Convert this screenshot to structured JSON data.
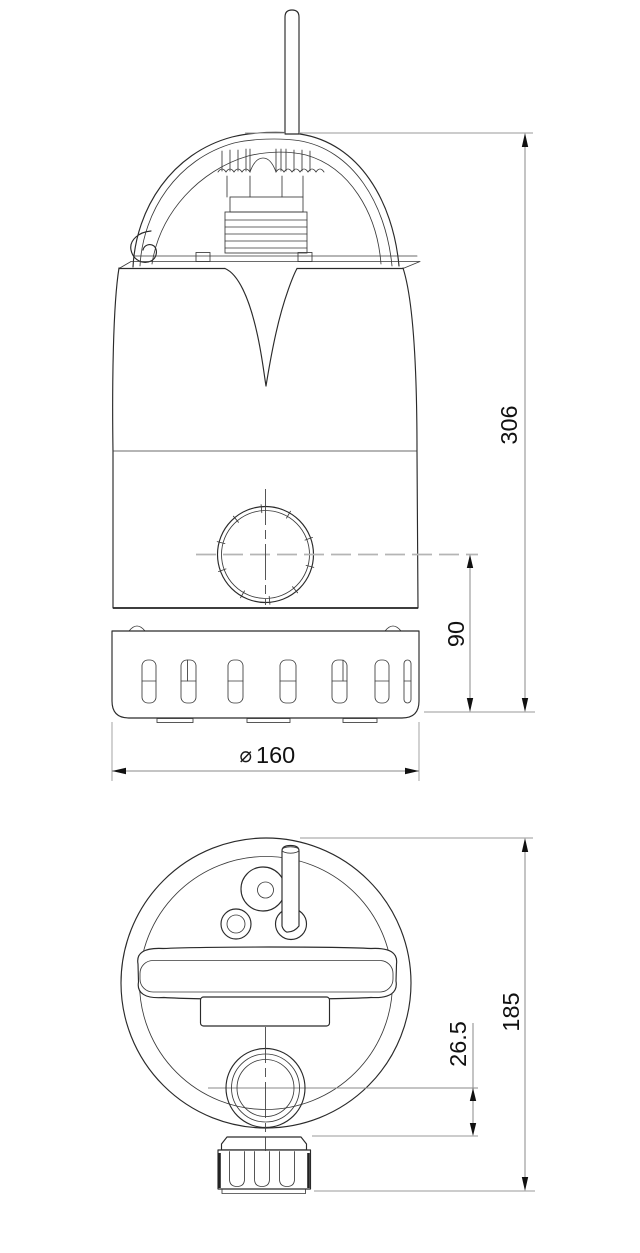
{
  "page": {
    "width": 640,
    "height": 1253,
    "background": "#ffffff"
  },
  "drawing": {
    "dimensions": {
      "front_view": {
        "overall_height": "306",
        "outlet_center_to_base": "90",
        "base_diameter_symbol": "⌀",
        "base_diameter_value": "160"
      },
      "top_view": {
        "overall_depth": "185",
        "outlet_center_offset": "26.5"
      }
    },
    "style": {
      "outline_color": "#2a2a2a",
      "dimension_line_color": "#8a8a8a",
      "centerline_color": "#b5b5b5",
      "text_color": "#111111"
    }
  }
}
